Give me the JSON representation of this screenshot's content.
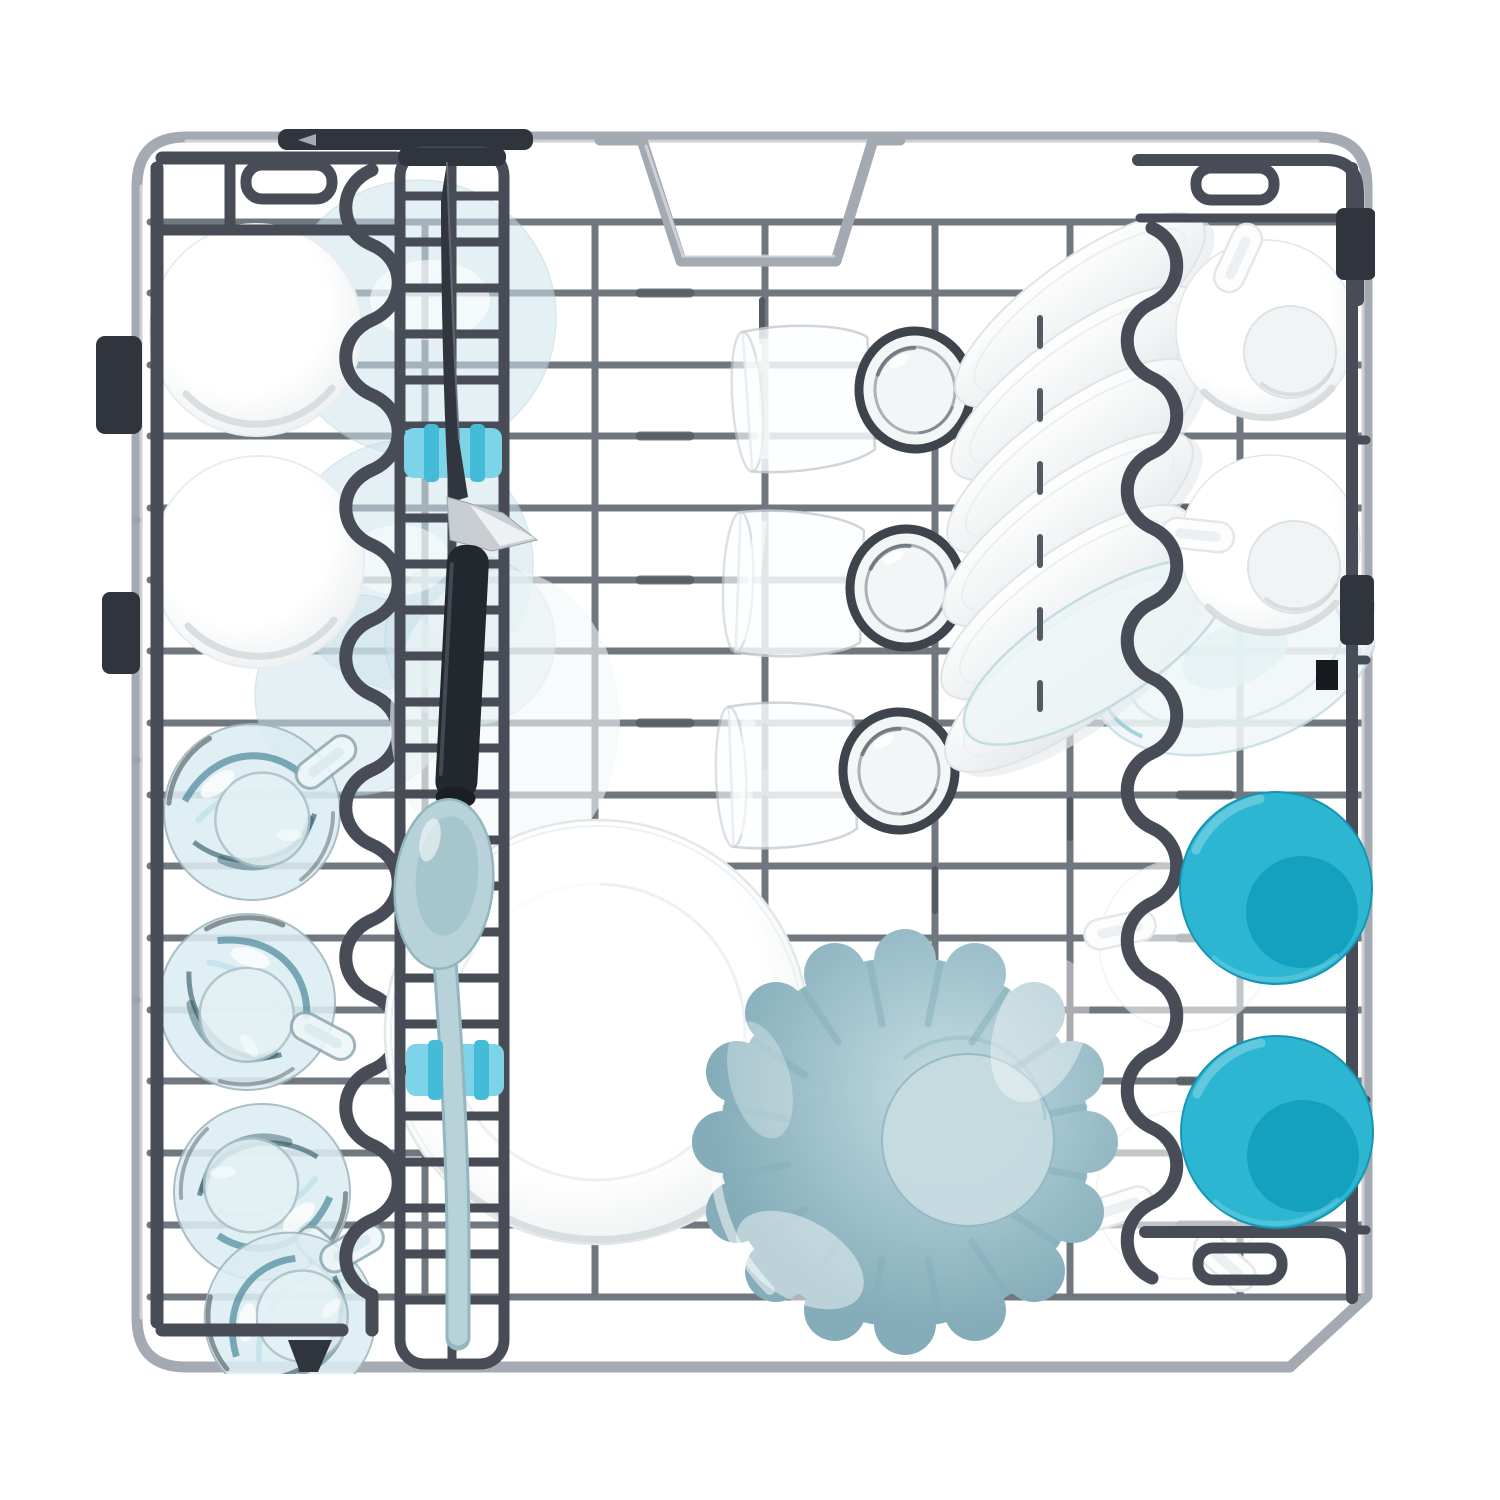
{
  "meta": {
    "description": "Top-down product photo of a dishwasher upper basket loaded with dishes on a white background",
    "background": "#ffffff"
  },
  "colors": {
    "white": "#ffffff",
    "white-shade": "#e6eaec",
    "white-shade2": "#d4d9dc",
    "wire": "#71777f",
    "wire-dark": "#545a62",
    "frame": "#a4aab1",
    "frame-dark": "#7b8188",
    "plastic": "#474c56",
    "plastic-dark": "#30343c",
    "glass-line": "#c7cdd2",
    "glass-dark": "#3e444b",
    "pale-blue": "#cfe5ec",
    "mug-fill": "#dcedf2",
    "mug-swirl": "#3f7e93",
    "mug-swirl-dark": "#27505f",
    "teal": "#2db6d2",
    "teal-dark": "#14a0bf",
    "spoon": "#b7d3d9",
    "spoon-dark": "#94b6be",
    "clip": "#7dd3e7",
    "clip-dark": "#45bcd7",
    "knife-dark": "#31363e",
    "knife-metal": "#c9ced3",
    "handle-dark": "#23272e",
    "bowl-blue": "#a4c5cf",
    "bowl-blue-light": "#c6dce1",
    "bowl-blue-dark": "#84adb9"
  },
  "scene": {
    "items": [
      {
        "id": "wire-basket",
        "label": "gray wire dishwasher basket with fold-down racks",
        "count": 1
      },
      {
        "id": "white-bowl",
        "label": "white bowl upside down in left rack",
        "count": 2
      },
      {
        "id": "glass-mug",
        "label": "glass espresso mug with handle, blue-tinted",
        "count": 4
      },
      {
        "id": "glass-side-plate",
        "label": "pale blue glass plate behind left rack",
        "count": 3
      },
      {
        "id": "utensil-tray",
        "label": "center utensil tray with ladder holes",
        "count": 1
      },
      {
        "id": "knife",
        "label": "dark-handled kitchen knife held by clip",
        "count": 1
      },
      {
        "id": "serving-spoon",
        "label": "light blue serving spoon held by clip",
        "count": 1
      },
      {
        "id": "blue-clip",
        "label": "light blue utensil retaining clip",
        "count": 2
      },
      {
        "id": "drinking-glass",
        "label": "clear tumbler lying on side",
        "count": 3
      },
      {
        "id": "white-plate-stack",
        "label": "white plates slotted at an angle",
        "count": 6
      },
      {
        "id": "glass-plate",
        "label": "clear glass plate / saucer",
        "count": 2
      },
      {
        "id": "white-cup",
        "label": "white cup upside down with handle",
        "count": 4
      },
      {
        "id": "teal-cup",
        "label": "bright teal cup upside down",
        "count": 2
      },
      {
        "id": "dinner-plate",
        "label": "large white dinner plate",
        "count": 1
      },
      {
        "id": "fluted-bowl",
        "label": "blue-gray fluted bowl upside down",
        "count": 1
      }
    ]
  }
}
